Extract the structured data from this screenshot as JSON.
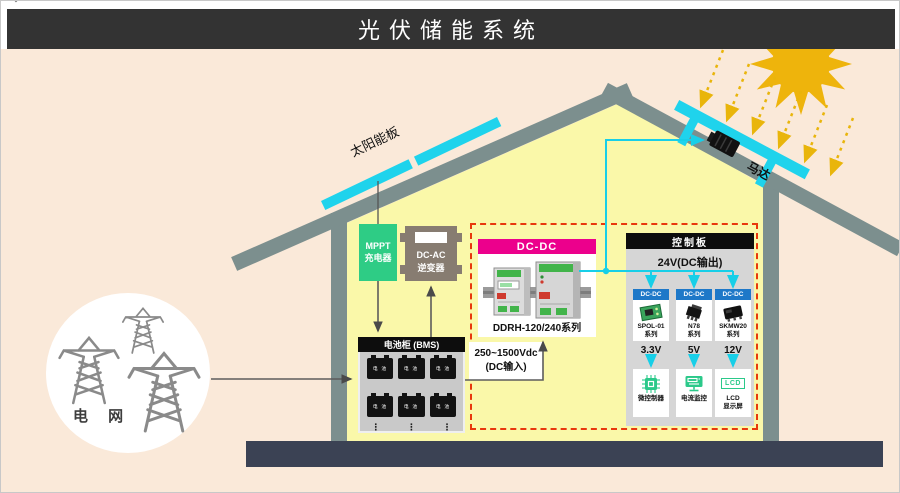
{
  "title": "光伏储能系统",
  "colors": {
    "accent_cyan": "#17cfe8",
    "accent_magenta": "#ec008c",
    "accent_green": "#2ecc85",
    "dashed_red": "#e8380d",
    "module_blue": "#1e78c8",
    "sun_gold": "#eeb40c",
    "roof_gray": "#7c8f8e",
    "base_dark": "#3b4254"
  },
  "scene": {
    "solar_panel_label": "太阳能板",
    "motor_label": "马达",
    "grid_label": "电 网"
  },
  "mppt": {
    "line1": "MPPT",
    "line2": "充电器"
  },
  "inverter": {
    "line1": "DC-AC",
    "line2": "逆变器"
  },
  "battery": {
    "header": "电池柜 (BMS)",
    "cell_label": "电 池",
    "ellipsis": "⋮"
  },
  "dcdc": {
    "header": "DC-DC",
    "model": "DDRH-120/240系列",
    "input_line1": "250~1500Vdc",
    "input_line2": "(DC输入)"
  },
  "control_board": {
    "header": "控制板",
    "output_label": "24V(DC输出)",
    "modules": [
      {
        "header": "DC-DC",
        "name_line1": "SPOL-01",
        "name_line2": "系列",
        "voltage": "3.3V"
      },
      {
        "header": "DC-DC",
        "name_line1": "N78",
        "name_line2": "系列",
        "voltage": "5V"
      },
      {
        "header": "DC-DC",
        "name_line1": "SKMW20",
        "name_line2": "系列",
        "voltage": "12V"
      }
    ],
    "outputs": [
      {
        "label": "微控制器"
      },
      {
        "label": "电流监控"
      },
      {
        "icon_text": "LCD",
        "label_line1": "LCD",
        "label_line2": "显示屏"
      }
    ]
  }
}
